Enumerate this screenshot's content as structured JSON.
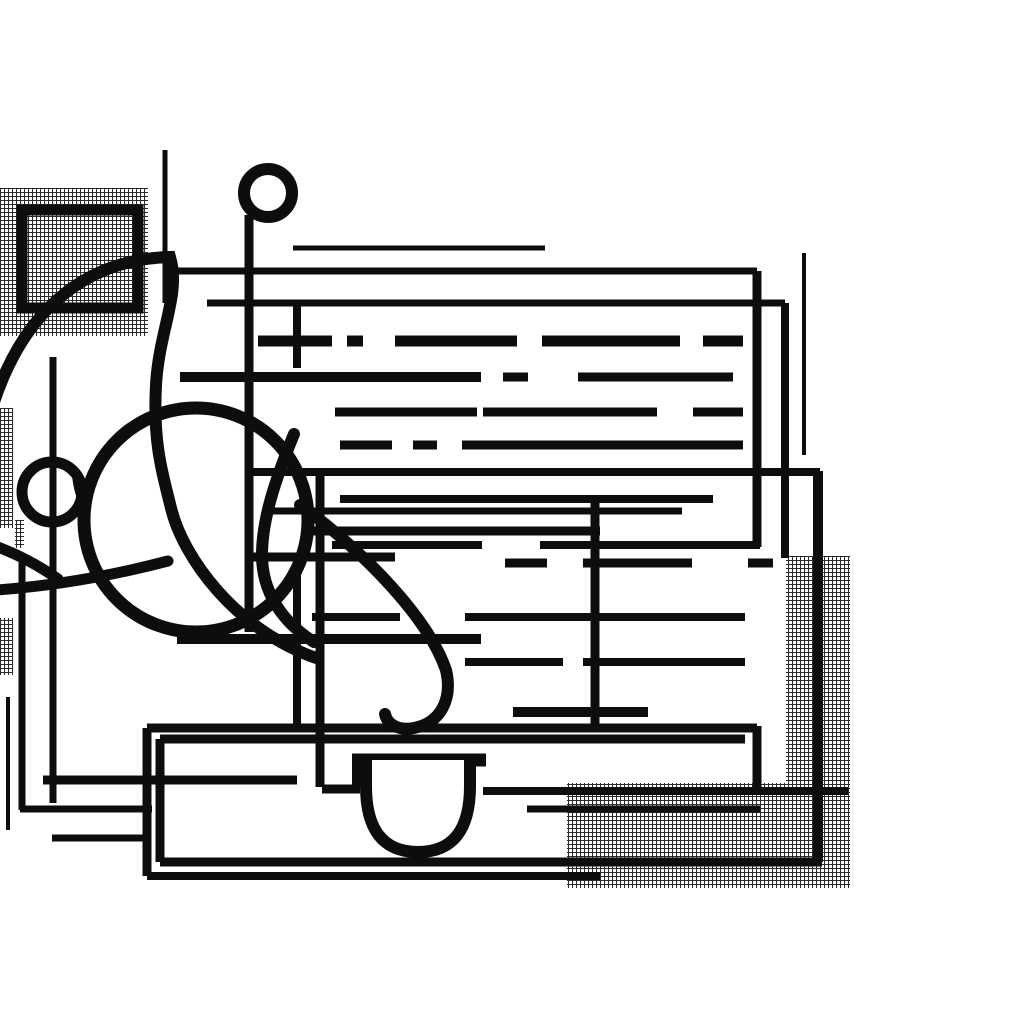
{
  "canvas": {
    "width": 1024,
    "height": 1024
  },
  "palette": {
    "background": "#ffffff",
    "ink": "#0d0d0d",
    "hatch_line": "#2a2a2a"
  },
  "scene": {
    "hatch_patches": [
      {
        "name": "hatch-topleft-block",
        "x": 0,
        "y": 188,
        "w": 148,
        "h": 148
      },
      {
        "name": "hatch-bottomright-block",
        "x": 567,
        "y": 556,
        "w": 283,
        "h": 332
      },
      {
        "name": "hatch-left-sliver-upper",
        "x": 0,
        "y": 408,
        "w": 13,
        "h": 120
      },
      {
        "name": "hatch-left-sliver-lower",
        "x": 0,
        "y": 618,
        "w": 13,
        "h": 57
      },
      {
        "name": "hatch-micro-glyphs",
        "x": 15,
        "y": 520,
        "w": 9,
        "h": 28
      }
    ],
    "white_masks": [
      {
        "name": "mask-over-bottomright-hatch",
        "x": 567,
        "y": 556,
        "w": 219,
        "h": 227
      }
    ],
    "outlined_rects": [
      {
        "name": "topleft-square-frame",
        "x": 22,
        "y": 210,
        "w": 116,
        "h": 98,
        "stroke": 11
      }
    ],
    "ink_lines": [
      [
        165,
        150,
        165,
        303,
        5
      ],
      [
        249,
        215,
        249,
        632,
        9
      ],
      [
        297,
        305,
        297,
        368,
        8
      ],
      [
        53,
        357,
        53,
        803,
        7
      ],
      [
        22,
        562,
        22,
        810,
        7
      ],
      [
        8,
        697,
        8,
        830,
        4
      ],
      [
        297,
        556,
        297,
        728,
        8
      ],
      [
        320,
        474,
        320,
        787,
        9
      ],
      [
        356,
        757,
        356,
        792,
        8
      ],
      [
        595,
        497,
        595,
        728,
        9
      ],
      [
        757,
        271,
        757,
        547,
        9
      ],
      [
        757,
        726,
        757,
        790,
        9
      ],
      [
        785,
        303,
        785,
        558,
        8
      ],
      [
        804,
        253,
        804,
        455,
        4
      ],
      [
        818,
        471,
        818,
        862,
        10
      ],
      [
        147,
        728,
        147,
        876,
        9
      ],
      [
        160,
        739,
        160,
        862,
        9
      ],
      [
        293,
        248,
        545,
        248,
        5
      ],
      [
        178,
        271,
        757,
        271,
        7
      ],
      [
        207,
        303,
        785,
        303,
        7
      ],
      [
        258,
        341,
        332,
        341,
        11
      ],
      [
        347,
        341,
        363,
        341,
        11
      ],
      [
        395,
        341,
        517,
        341,
        11
      ],
      [
        542,
        341,
        680,
        341,
        11
      ],
      [
        703,
        341,
        743,
        341,
        11
      ],
      [
        180,
        377,
        481,
        377,
        10
      ],
      [
        503,
        377,
        528,
        377,
        9
      ],
      [
        578,
        377,
        733,
        377,
        9
      ],
      [
        335,
        412,
        477,
        412,
        9
      ],
      [
        483,
        412,
        657,
        412,
        9
      ],
      [
        693,
        412,
        743,
        412,
        9
      ],
      [
        340,
        445,
        392,
        445,
        9
      ],
      [
        413,
        445,
        437,
        445,
        9
      ],
      [
        462,
        445,
        743,
        445,
        9
      ],
      [
        245,
        472,
        820,
        472,
        8
      ],
      [
        340,
        499,
        713,
        499,
        8
      ],
      [
        268,
        511,
        682,
        511,
        7
      ],
      [
        310,
        531,
        600,
        531,
        9
      ],
      [
        332,
        545,
        482,
        545,
        8
      ],
      [
        540,
        545,
        760,
        545,
        8
      ],
      [
        250,
        557,
        395,
        557,
        9
      ],
      [
        505,
        563,
        547,
        563,
        9
      ],
      [
        583,
        563,
        692,
        563,
        9
      ],
      [
        748,
        563,
        773,
        563,
        9
      ],
      [
        312,
        617,
        400,
        617,
        8
      ],
      [
        465,
        617,
        745,
        617,
        8
      ],
      [
        177,
        639,
        481,
        639,
        10
      ],
      [
        465,
        662,
        563,
        662,
        8
      ],
      [
        583,
        662,
        745,
        662,
        8
      ],
      [
        513,
        712,
        648,
        712,
        10
      ],
      [
        147,
        728,
        757,
        728,
        9
      ],
      [
        160,
        739,
        745,
        739,
        9
      ],
      [
        43,
        780,
        297,
        780,
        9
      ],
      [
        322,
        789,
        360,
        789,
        9
      ],
      [
        483,
        791,
        848,
        791,
        8
      ],
      [
        20,
        809,
        152,
        809,
        7
      ],
      [
        527,
        809,
        760,
        809,
        7
      ],
      [
        52,
        838,
        150,
        838,
        7
      ],
      [
        160,
        862,
        822,
        862,
        9
      ],
      [
        147,
        876,
        600,
        876,
        8
      ],
      [
        352,
        760,
        486,
        760,
        13
      ]
    ],
    "rings": [
      {
        "name": "small-ring-top",
        "cx": 268,
        "cy": 193,
        "r": 24,
        "stroke": 12
      },
      {
        "name": "small-ring-left",
        "cx": 52,
        "cy": 492,
        "r": 30,
        "stroke": 11
      },
      {
        "name": "large-circle-left",
        "cx": 196,
        "cy": 520,
        "r": 112,
        "stroke": 13
      }
    ],
    "filled_shapes": [
      {
        "name": "intersection-blob",
        "d": "M 72 474 Q 93 489 90 518 Q 74 503 72 474 Z"
      }
    ],
    "stroke_paths": [
      {
        "name": "sweep-arc-and-s-curve",
        "w": 12,
        "fill": "none",
        "d": "M -6 402 C 28 300 95 259 170 257 C 181 294 159 330 156 385 C 153 440 161 468 171 508 C 183 558 236 630 316 658"
      },
      {
        "name": "inner-strand-curve",
        "w": 12,
        "fill": "none",
        "d": "M 294 434 C 275 480 262 520 262 555 C 262 592 282 622 314 642"
      },
      {
        "name": "diagonal-hook-curve",
        "w": 12,
        "fill": "none",
        "d": "M 300 505 C 352 542 426 612 446 670 C 453 700 440 723 414 728 C 398 731 387 724 385 714"
      },
      {
        "name": "lower-left-gentle-arc",
        "w": 11,
        "fill": "none",
        "d": "M -4 590 Q 80 584 168 561"
      },
      {
        "name": "corner-edge-arc",
        "w": 11,
        "fill": "none",
        "d": "M -5 546 Q 28 558 58 579"
      },
      {
        "name": "cup-bowl",
        "w": 12,
        "fill": "#ffffff",
        "d": "M 366 760 L 366 786 Q 366 852 418 852 Q 470 852 470 786 L 470 760"
      }
    ]
  }
}
